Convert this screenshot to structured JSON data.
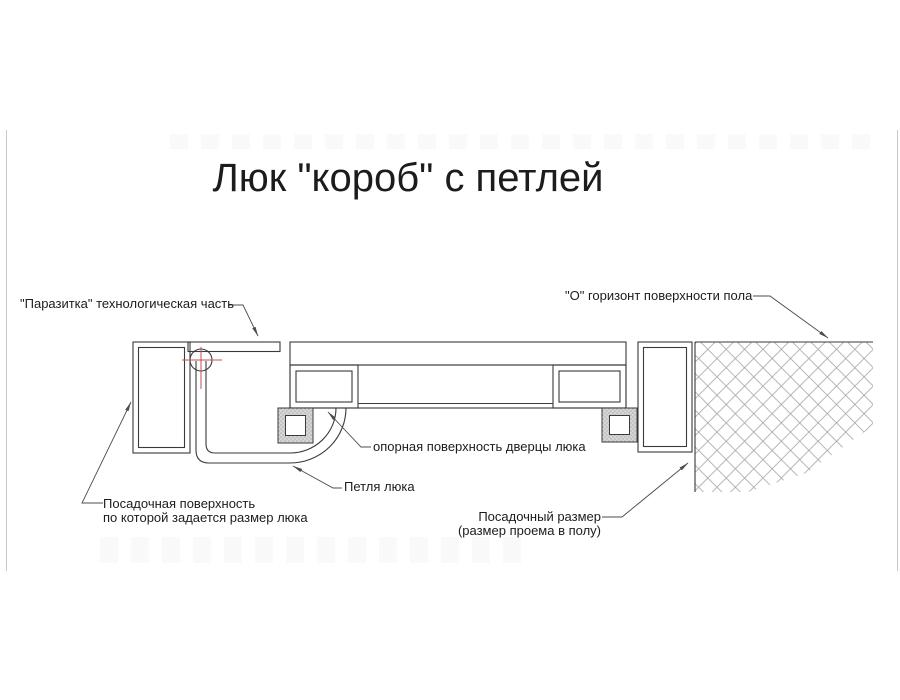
{
  "title": "Люк \"короб\" с петлей",
  "labels": {
    "parasitka": "\"Паразитка\" технологическая часть",
    "floor_horizon": "\"О\" горизонт поверхности пола",
    "door_support": "опорная поверхность дверцы люка",
    "hinge": "Петля люка",
    "seating_surface_1": "Посадочная поверхность",
    "seating_surface_2": "по которой задается размер люка",
    "seating_size_1": "Посадочный размер",
    "seating_size_2": "(размер проема в полу)"
  },
  "colors": {
    "line": "#3a3a3a",
    "leader": "#4c4c4c",
    "hatch": "#a5a5a5",
    "centerline": "#c0504d",
    "stipple-bg": "#d6d6d6",
    "stipple-dot": "#9a9a9a",
    "page-edge": "#c9c9c9",
    "background": "#ffffff",
    "text": "#1c1c1c"
  }
}
